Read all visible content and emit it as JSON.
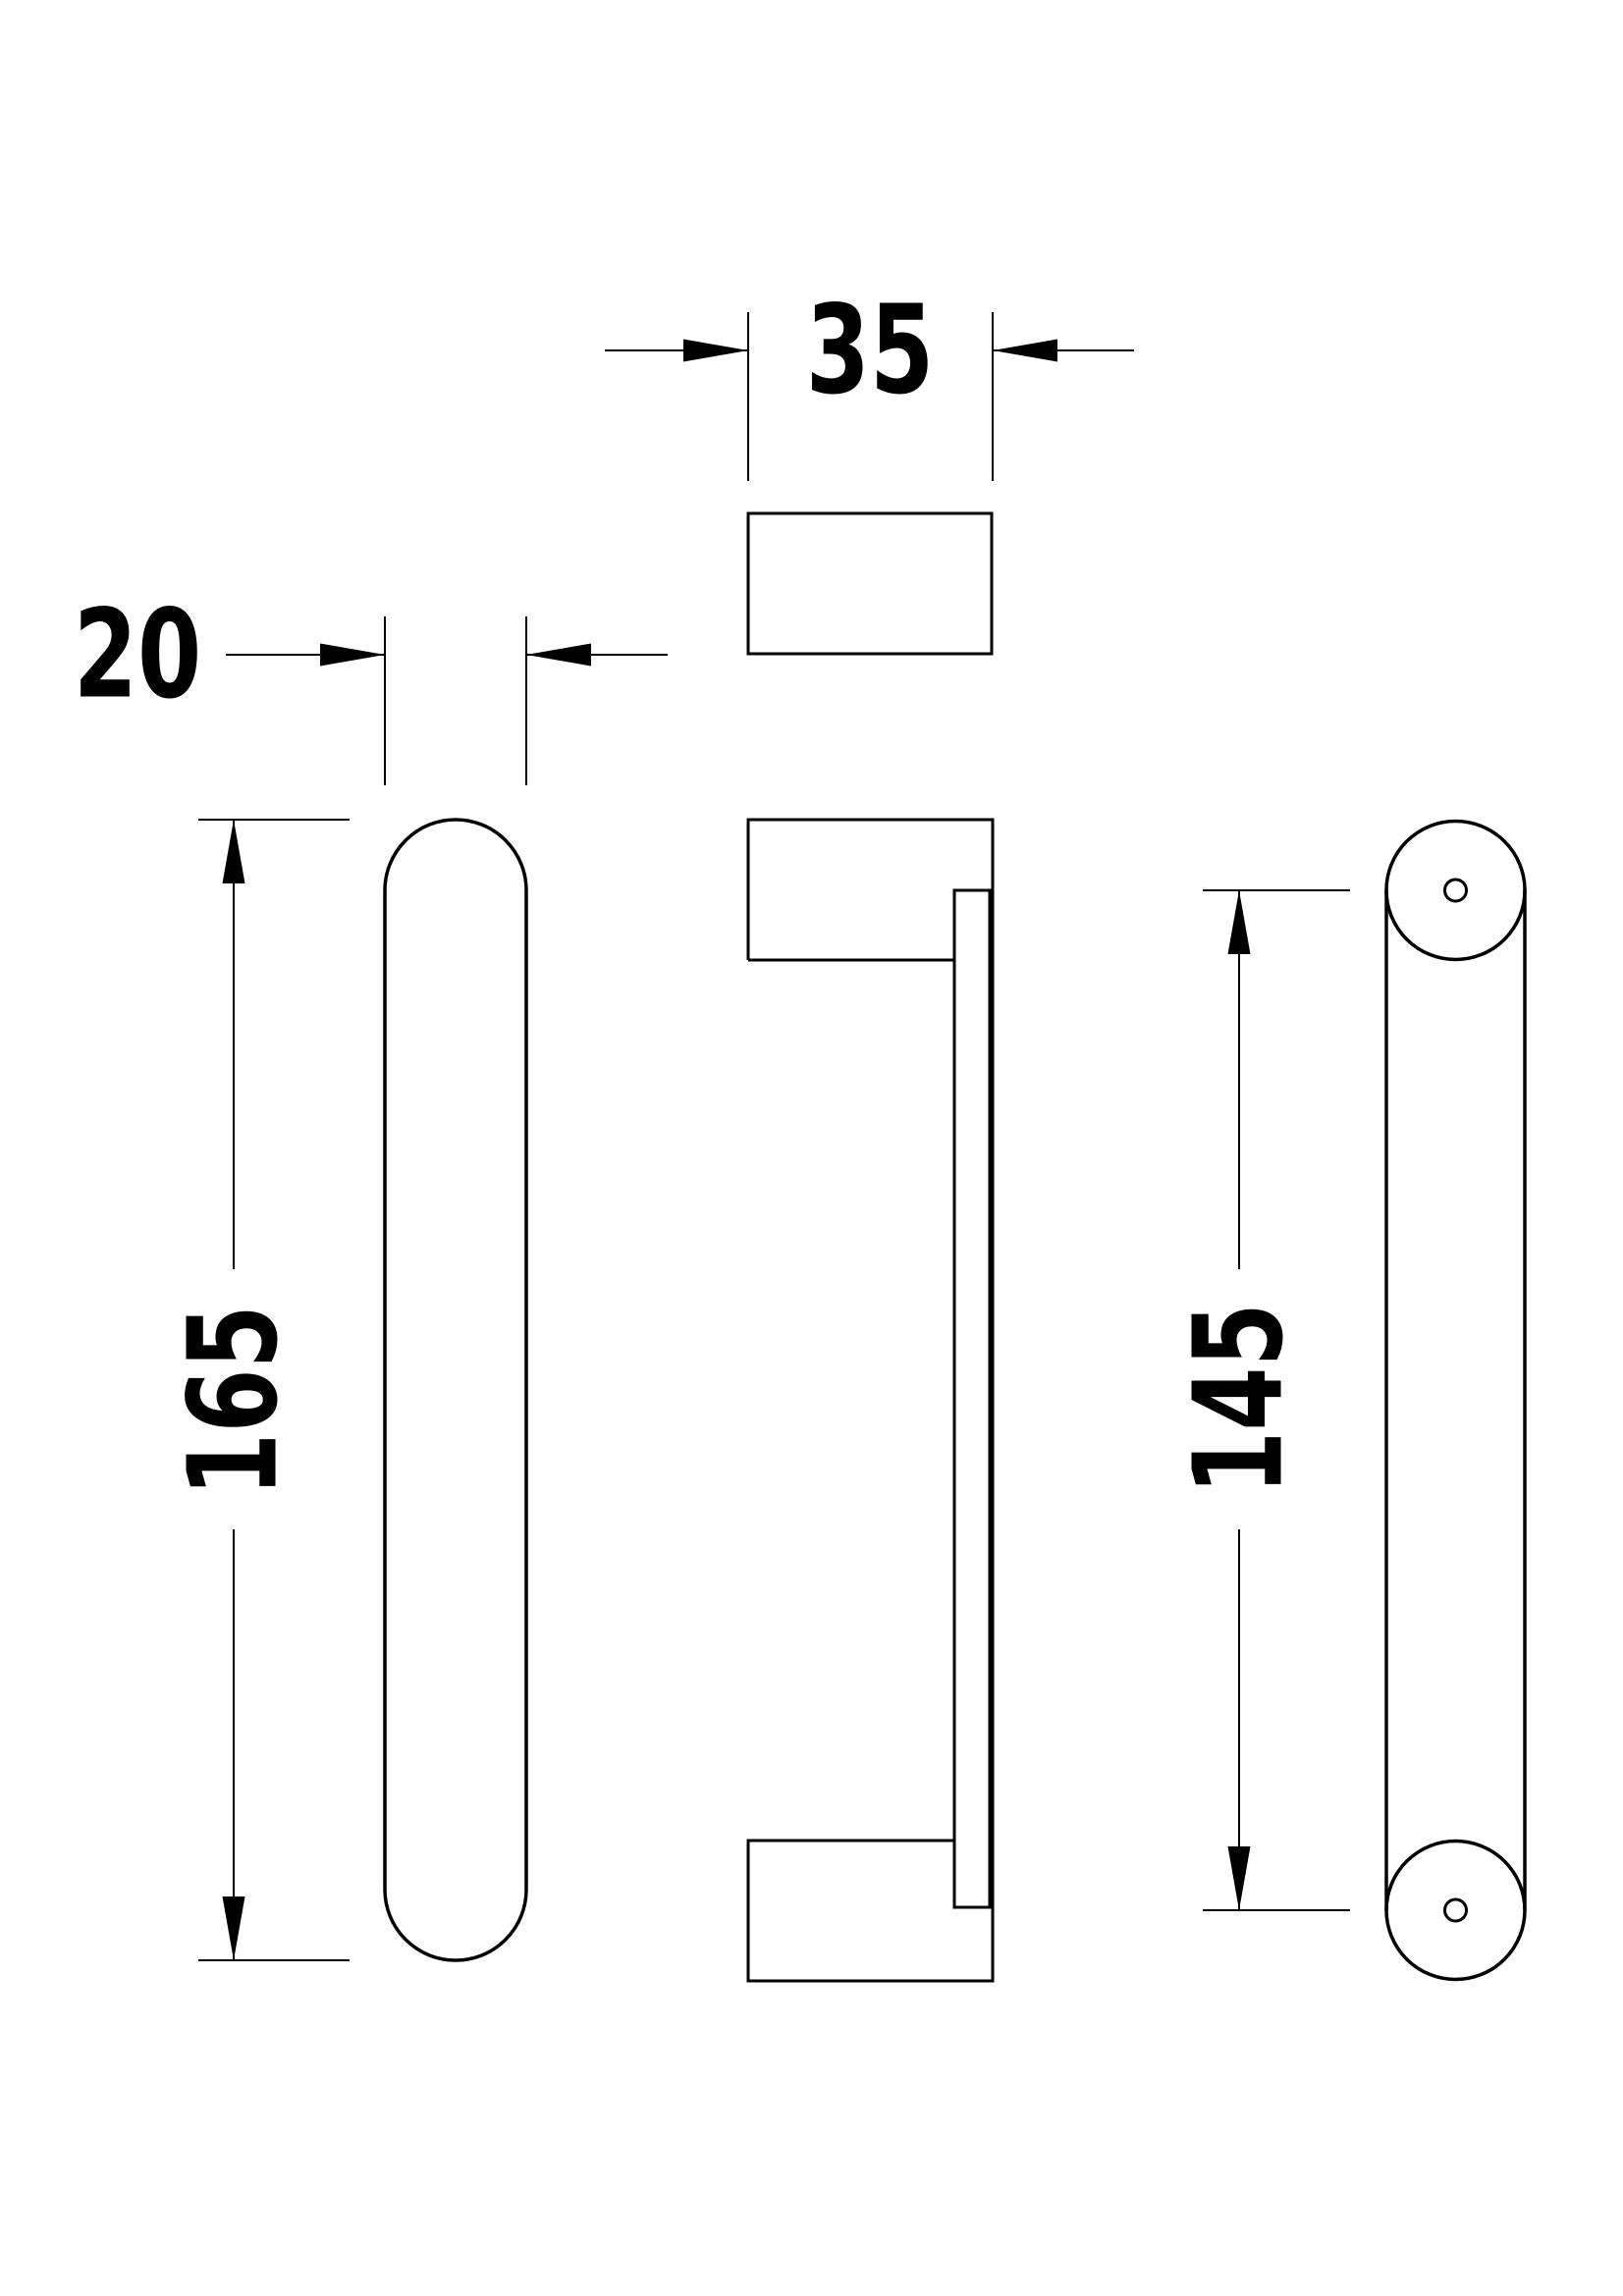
{
  "drawing": {
    "background_color": "#ffffff",
    "line_color": "#000000",
    "labels": {
      "width": "35",
      "depth": "20",
      "length": "165",
      "hole_spacing": "145"
    }
  }
}
